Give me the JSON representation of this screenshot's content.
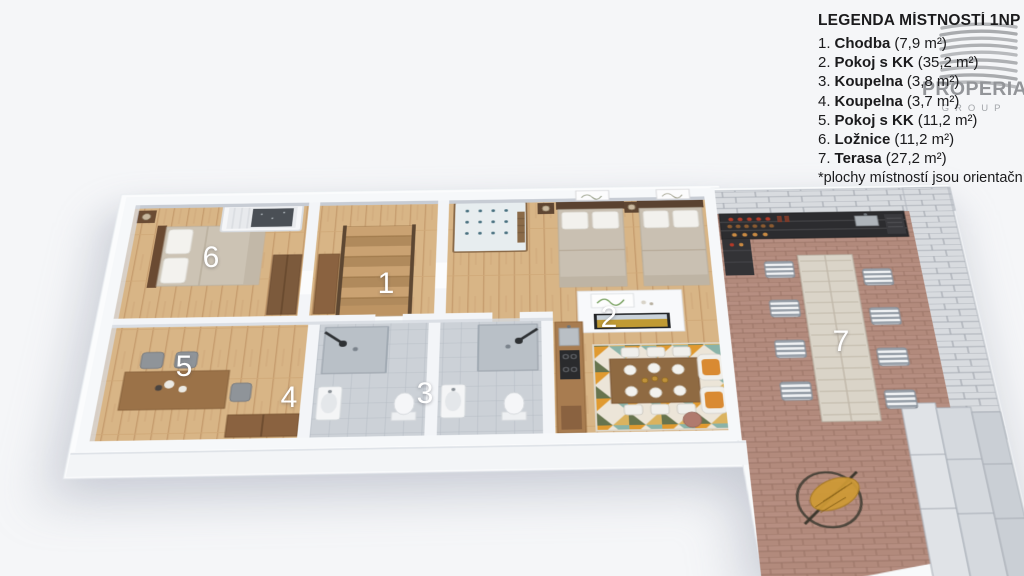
{
  "scene": {
    "description": "3D rendered floor plan of apartment ground floor (1NP)",
    "background_color": "#f5f6f8"
  },
  "legend": {
    "title": "LEGENDA MÍSTNOSTÍ 1NP",
    "items": [
      {
        "num": "1.",
        "name": "Chodba",
        "area": "(7,9 m²)"
      },
      {
        "num": "2.",
        "name": "Pokoj s KK",
        "area": "(35,2 m²)"
      },
      {
        "num": "3.",
        "name": "Koupelna",
        "area": "(3,8 m²)"
      },
      {
        "num": "4.",
        "name": "Koupelna",
        "area": "(3,7 m²)"
      },
      {
        "num": "5.",
        "name": "Pokoj s KK",
        "area": "(11,2 m²)"
      },
      {
        "num": "6.",
        "name": "Ložnice",
        "area": "(11,2 m²)"
      },
      {
        "num": "7.",
        "name": "Terasa",
        "area": "(27,2  m²)"
      }
    ],
    "footnote": "*plochy místností jsou orientační"
  },
  "logo": {
    "name": "PROPERIA",
    "subtitle": "GROUP"
  },
  "floorplan": {
    "labels": {
      "r1": "1",
      "r2": "2",
      "r3": "3",
      "r4": "4",
      "r5": "5",
      "r6": "6",
      "r7": "7"
    }
  },
  "colors": {
    "wood_floor": "#d8b586",
    "bathroom_tile": "#ccd1d7",
    "terrace_brick": "#b28a7c",
    "stone_wall": "#d8dbdf",
    "wall_white": "#f6f8fa",
    "rug_orange": "#e09a30",
    "rug_teal": "#8ab3a8",
    "rug_olive": "#67744e",
    "armchair_cushion": "#d98a32",
    "legend_text": "#1b1b1d",
    "logo_gray": "#939599",
    "room_number": "#ffffff"
  }
}
